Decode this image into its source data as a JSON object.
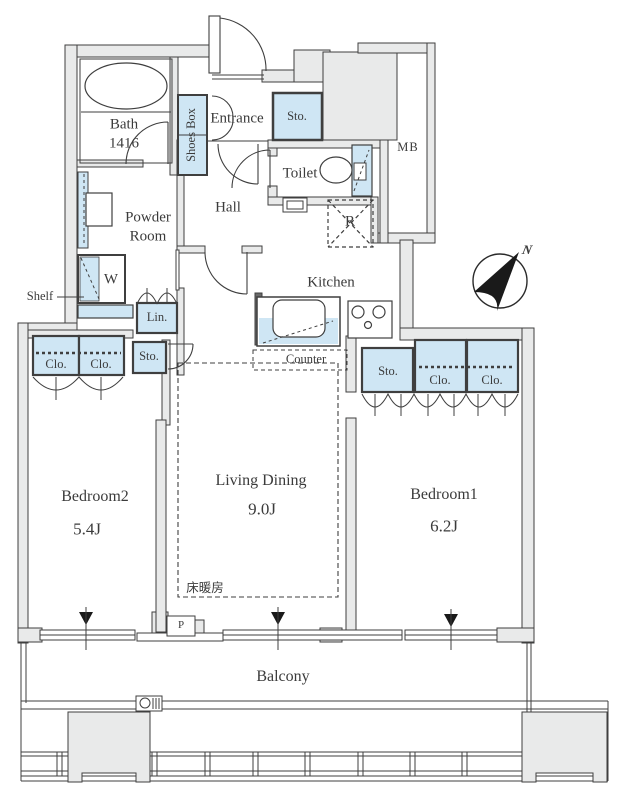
{
  "meta": {
    "type": "apartment-floor-plan",
    "colors": {
      "wall_fill": "#e9eaea",
      "fixture_blue": "#cfe6f4",
      "line": "#3f3f3f"
    }
  },
  "labels": {
    "bath": "Bath",
    "bath_size": "1416",
    "shoes_box": "Shoes Box",
    "entrance": "Entrance",
    "entrance_storage": "Sto.",
    "toilet": "Toilet",
    "meter_box": "MB",
    "powder_room": "Powder Room",
    "washer": "W",
    "shelf": "Shelf",
    "linen": "Lin.",
    "hall_storage": "Sto.",
    "hall": "Hall",
    "refrigerator": "R",
    "kitchen": "Kitchen",
    "counter": "Counter",
    "bedroom2": "Bedroom2",
    "bedroom2_size": "5.4J",
    "bedroom2_closet_left": "Clo.",
    "bedroom2_closet_right": "Clo.",
    "living_dining": "Living Dining",
    "living_dining_size": "9.0J",
    "floor_heating": "床暖房",
    "bedroom1": "Bedroom1",
    "bedroom1_size": "6.2J",
    "bedroom1_storage": "Sto.",
    "bedroom1_closet_left": "Clo.",
    "bedroom1_closet_right": "Clo.",
    "pipe_space": "P",
    "balcony": "Balcony",
    "compass_north": "N"
  }
}
